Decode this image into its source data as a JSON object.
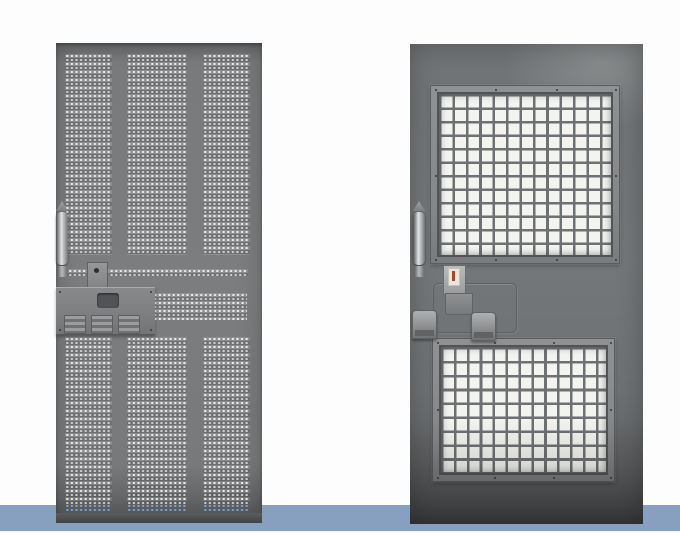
{
  "scene": {
    "type": "product-photo",
    "description": "Two gray steel detention security doors standing side by side on a white background over a steel-blue floor band",
    "text_visible": "none"
  },
  "floor_band": {
    "color": "#87a0c0",
    "position": "full-width strip near bottom, doors overlap it"
  },
  "left_door": {
    "name": "perforated-detention-door",
    "style": "fully perforated steel door",
    "perforated_areas": {
      "upper_columns": 3,
      "lower_columns": 3,
      "horizontal_strip_rows": 2,
      "mid_right_band_rows": 4,
      "bottom_rows_show_blue_through_holes": true
    },
    "hardware": [
      "pull-handle",
      "lock-cylinder-with-keyhole",
      "lock-cover-plate",
      "three-latch-keepers"
    ]
  },
  "right_door": {
    "name": "glazed-detention-door",
    "style": "steel door with two bar-grille vision panels",
    "windows": {
      "upper": {
        "grid_cols": 13,
        "grid_rows": 12,
        "frame_screws": 10
      },
      "lower": {
        "grid_cols": 13,
        "grid_rows": 9,
        "frame_screws": 10
      }
    },
    "hardware": [
      "pull-handle",
      "lock-cylinder-with-spec-label",
      "lock-body",
      "engraved-lock-plate-outline",
      "two-paddle-latches"
    ]
  },
  "colors": {
    "background": "#fdfdfd",
    "floor_band": "#87a0c0",
    "door_gray": "#77797b",
    "door_gray_dark": "#4c4e50",
    "hole_light": "#eaeae8",
    "hole_blue": "#7fa0c8",
    "frame_gray": "#8b8d8f",
    "grille_bar": "#6e7173",
    "glass": "#f3f3f0",
    "hardware_light": "#b9babb",
    "screw_dark": "#35373a",
    "label_red": "#a5492b"
  }
}
